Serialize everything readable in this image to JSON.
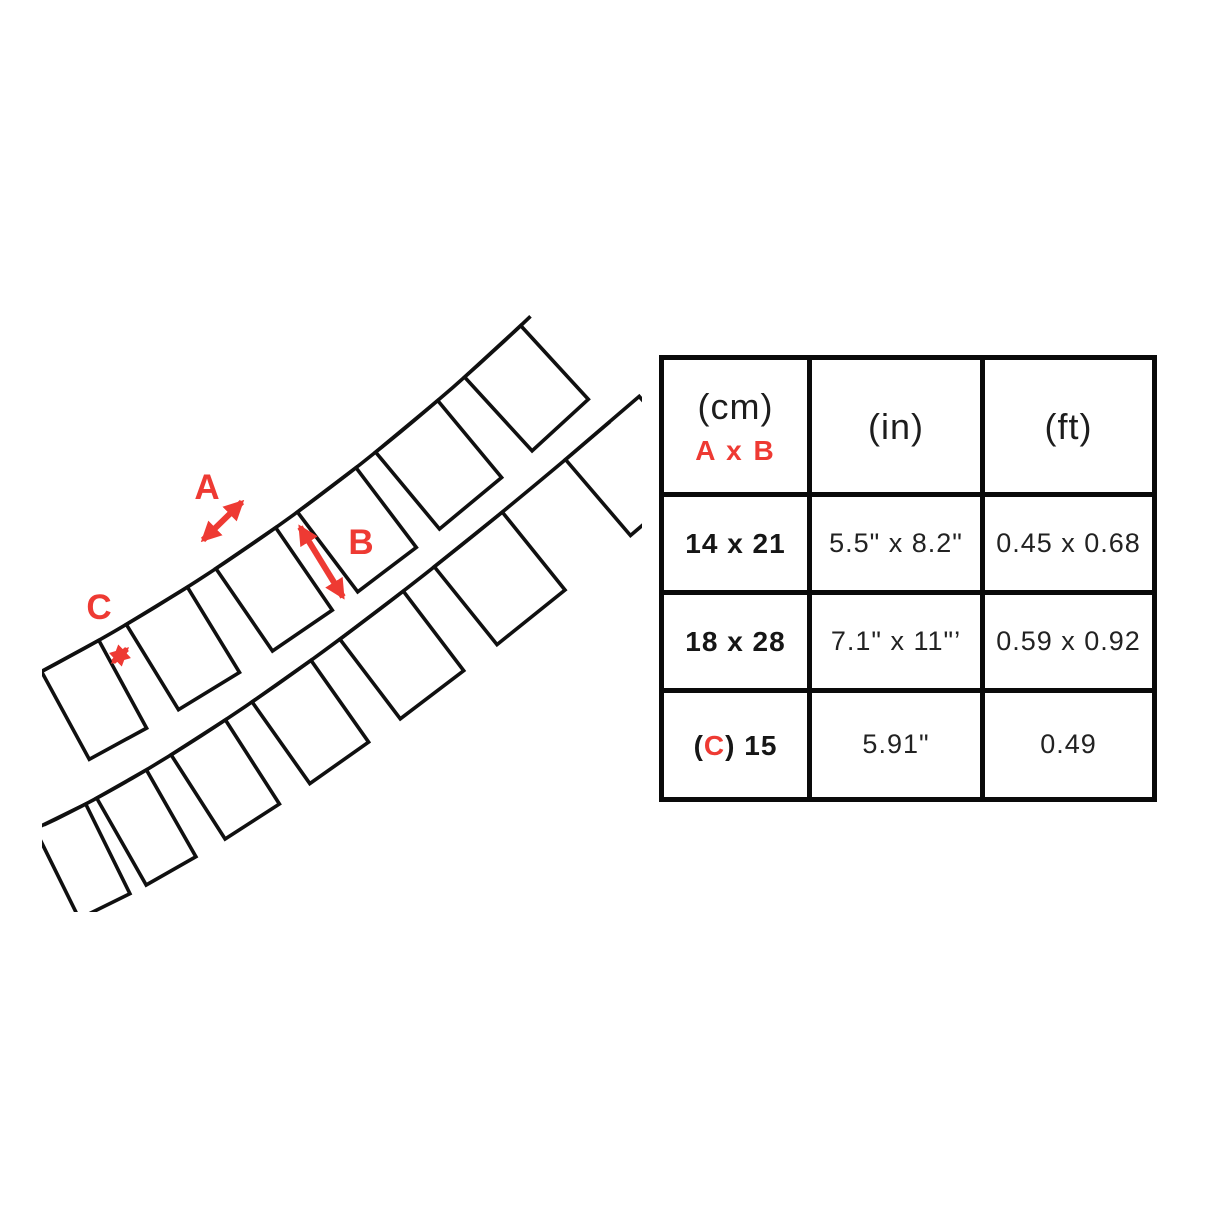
{
  "diagram": {
    "labels": {
      "a": "A",
      "b": "B",
      "c": "C"
    },
    "line_color": "#101010",
    "accent_color": "#ee3a33"
  },
  "table": {
    "border_color": "#0a0a0a",
    "header": {
      "cm_unit": "(cm)",
      "cm_sub": "A x B",
      "in_unit": "(in)",
      "ft_unit": "(ft)"
    },
    "rows": [
      {
        "cm": "14 x 21",
        "in": "5.5\" x 8.2\"",
        "ft": "0.45 x 0.68"
      },
      {
        "cm": "18 x 28",
        "in": "7.1\" x 11\"’",
        "ft": "0.59 x 0.92"
      },
      {
        "cm_open": "(",
        "cm_c": "C",
        "cm_close": ") 15",
        "in": "5.91\"",
        "ft": "0.49"
      }
    ]
  }
}
